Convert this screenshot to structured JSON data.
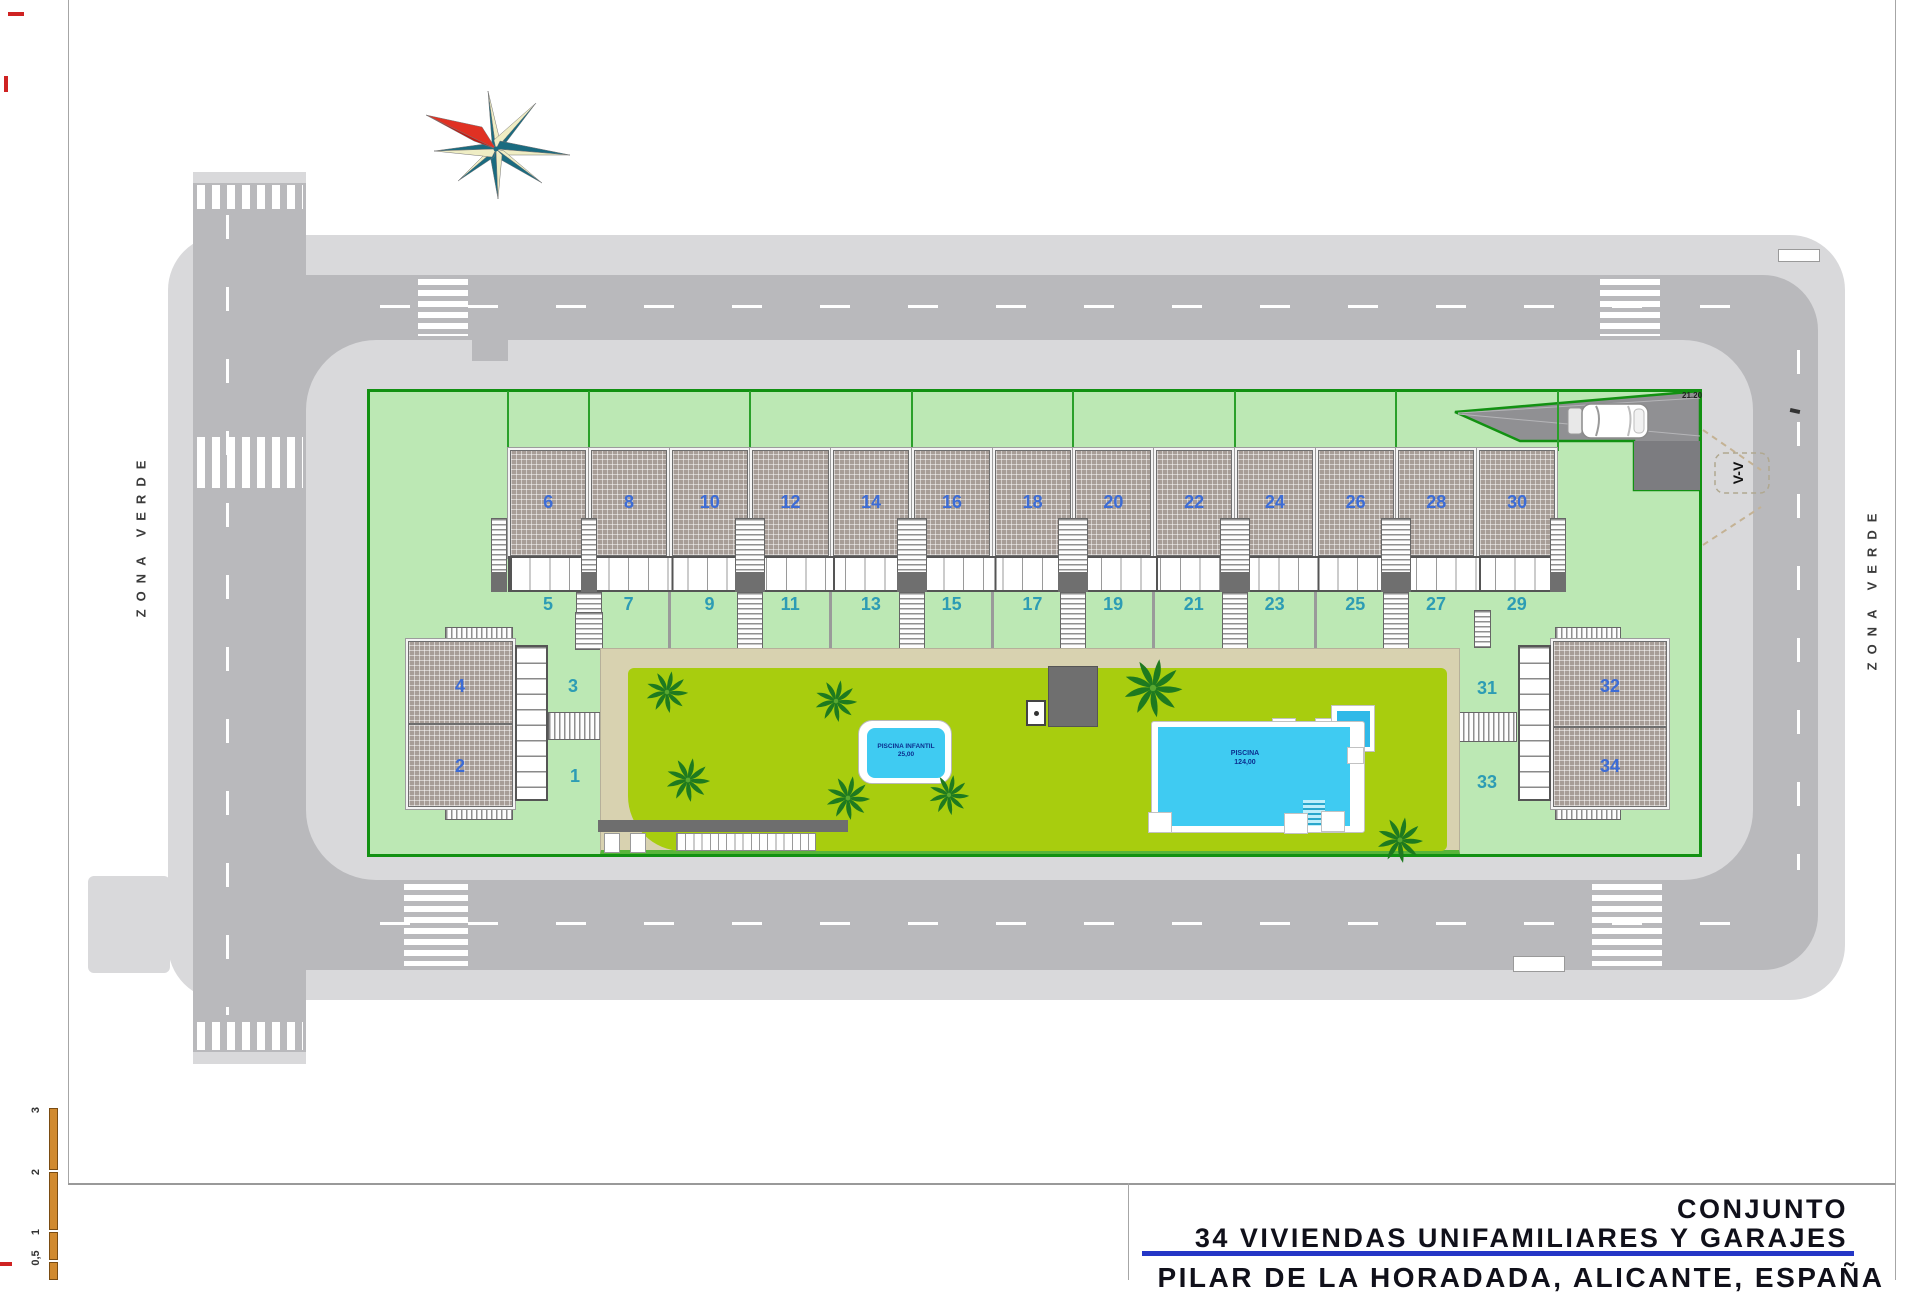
{
  "title_block": {
    "project_type": "CONJUNTO",
    "project_name": "34 VIVIENDAS UNIFAMILIARES Y GARAJES",
    "location": "PILAR DE LA HORADADA, ALICANTE, ESPAÑA"
  },
  "zone_labels": {
    "left": "ZONA VERDE",
    "right": "ZONA VERDE"
  },
  "section_marker": "V-V",
  "ramp_dimension": "21.20",
  "pools": {
    "small": {
      "label": "PISCINA INFANTIL",
      "area": "25,00"
    },
    "large": {
      "label": "PISCINA",
      "area": "124,00"
    }
  },
  "scale_bar": {
    "labels": [
      "3",
      "2",
      "1",
      "0,5"
    ]
  },
  "units": {
    "row_upper": [
      "6",
      "8",
      "10",
      "12",
      "14",
      "16",
      "18",
      "20",
      "22",
      "24",
      "26",
      "28",
      "30"
    ],
    "row_lower": [
      "5",
      "7",
      "9",
      "11",
      "13",
      "15",
      "17",
      "19",
      "21",
      "23",
      "25",
      "27",
      "29"
    ],
    "left_building": {
      "upper": "4",
      "lower": "2",
      "plot_upper": "3",
      "plot_lower": "1"
    },
    "right_building": {
      "upper": "32",
      "lower": "34",
      "plot_upper": "31",
      "plot_lower": "33"
    }
  },
  "colors": {
    "road": "#b9b9bc",
    "sidewalk": "#d9d9db",
    "parcel_green": "#bce8b4",
    "border_green": "#129112",
    "lawn_green": "#a8cd0e",
    "path_tan": "#d8d2b0",
    "pool_cyan": "#3fcbf2",
    "unit_blue": "#3c6cd6",
    "plot_teal": "#2d9cb4",
    "title_blue": "#2436c6",
    "scale_orange": "#d18a2f",
    "compass_red": "#e03123",
    "compass_teal": "#1a6b80",
    "compass_pale": "#efedc4"
  }
}
